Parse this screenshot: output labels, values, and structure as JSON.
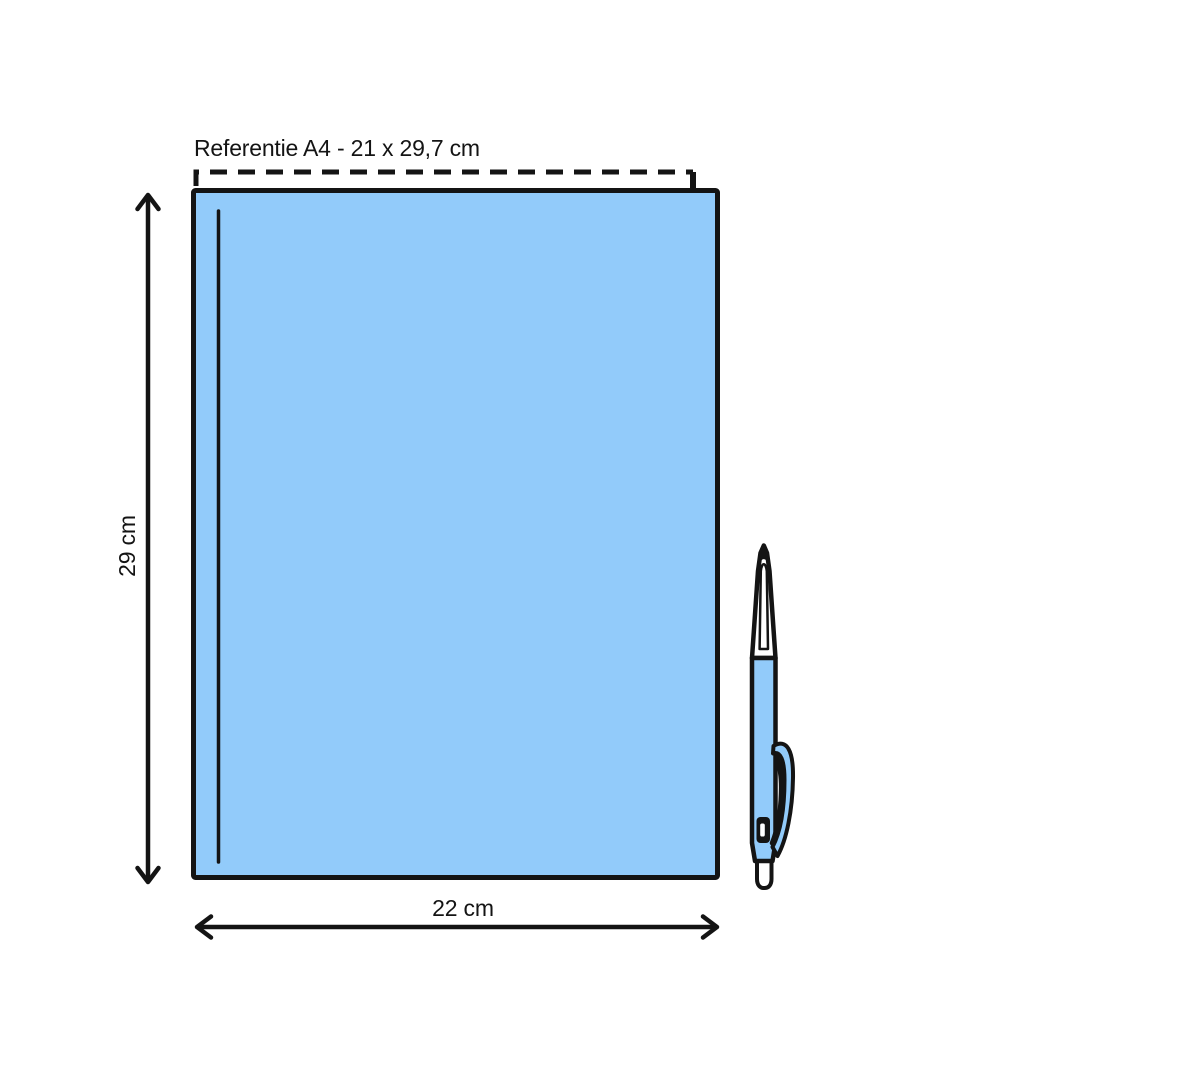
{
  "colors": {
    "paper-blue": "#92CBFA",
    "ink": "#141414",
    "bg": "#ffffff"
  },
  "diagram": {
    "title_label": "Referentie A4 - 21 x 29,7 cm",
    "height_label": "29 cm",
    "width_label": "22 cm",
    "reference_format": {
      "name": "A4",
      "width_cm": "21",
      "height_cm": "29,7"
    },
    "product_size": {
      "width_cm": "22",
      "height_cm": "29"
    }
  }
}
